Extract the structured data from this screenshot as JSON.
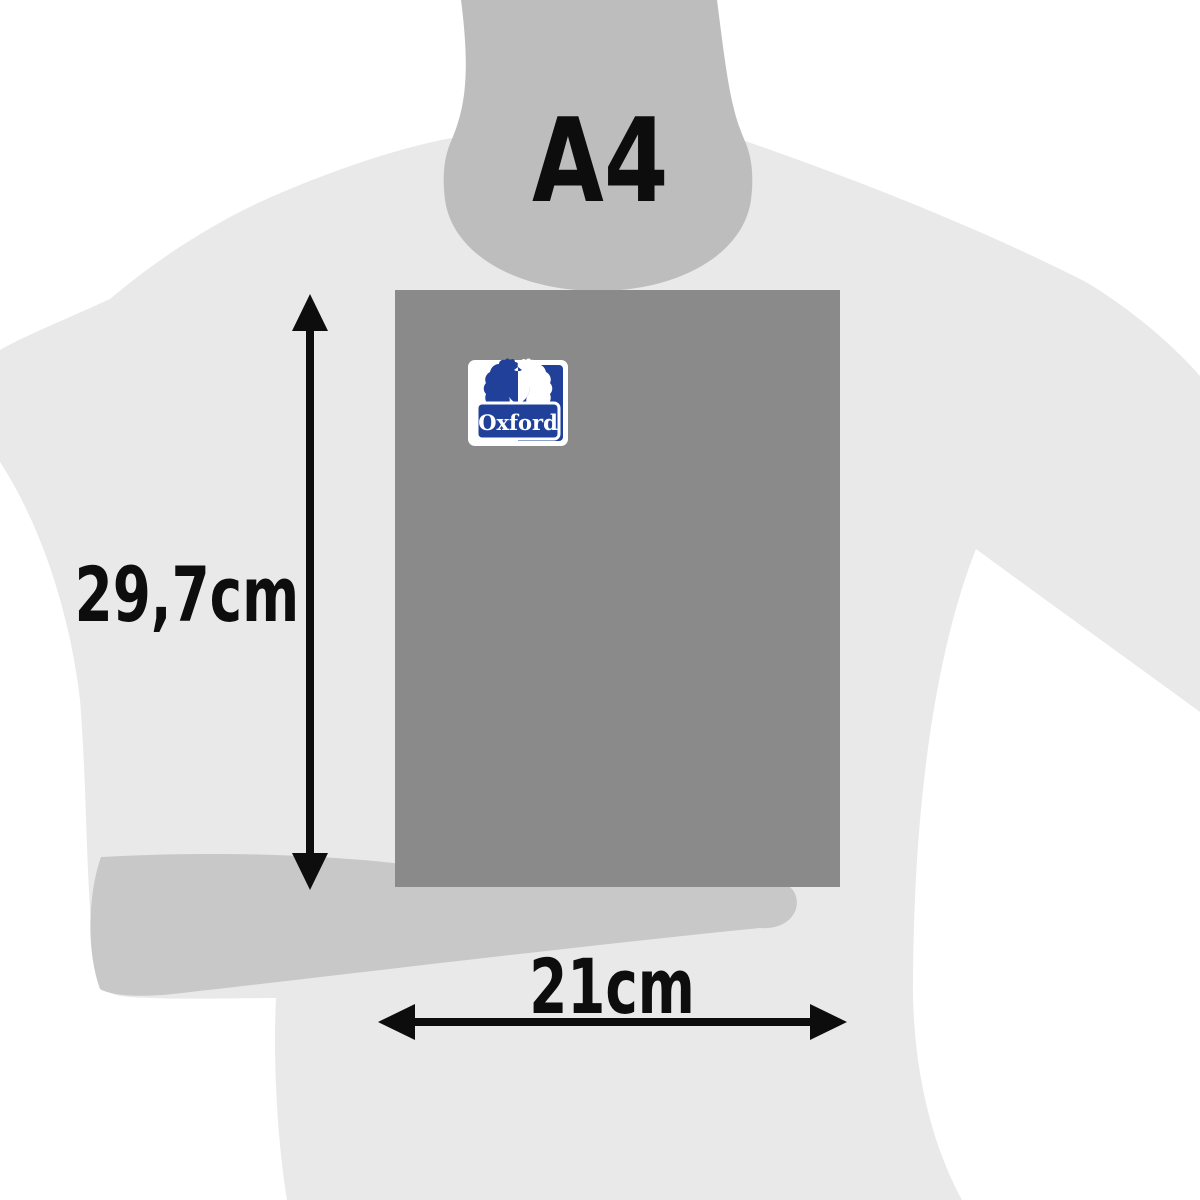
{
  "product_size_diagram": {
    "format_label": "A4",
    "height_label": "29,7cm",
    "width_label": "21cm"
  },
  "logo": {
    "text": "Oxford",
    "blue": "#21409a",
    "white": "#ffffff"
  },
  "colors": {
    "background": "#ffffff",
    "body": "#e9e9e9",
    "head": "#bdbdbd",
    "hand": "#c8c8c8",
    "notebook": "#8a8a8a",
    "annotation": "#0d0d0d"
  }
}
